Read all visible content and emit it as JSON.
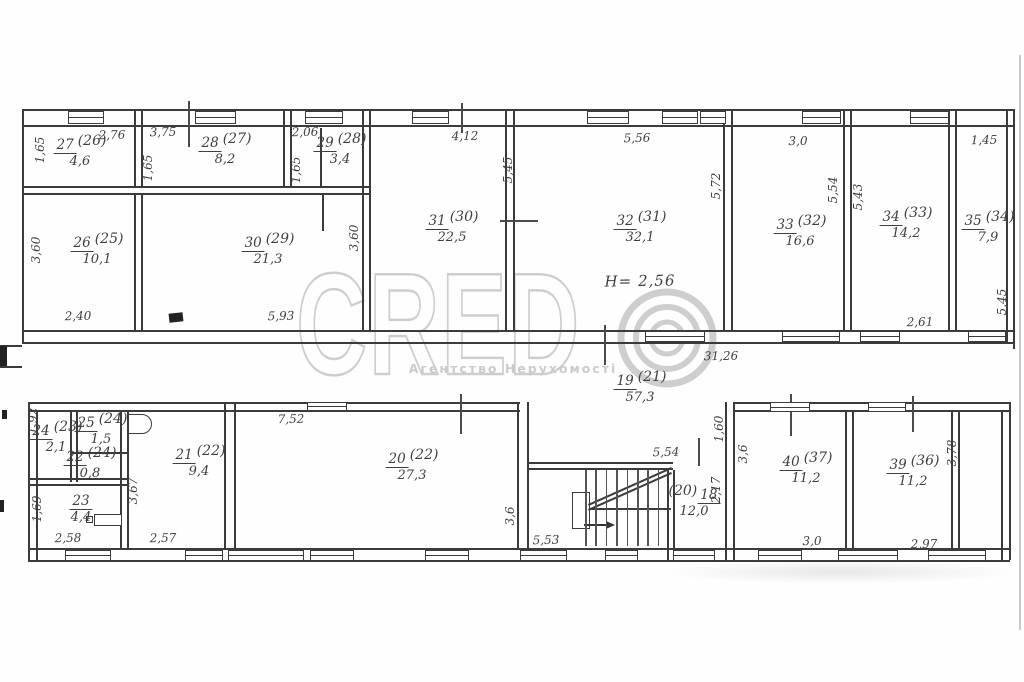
{
  "watermark": {
    "brand": "CREDO",
    "brand_text": "CRED",
    "subtitle": "Агентство Нерухомості"
  },
  "colors": {
    "ink": "#3b3b3b",
    "hand": "#3f3f3f",
    "watermark": "#c6c6c6"
  },
  "height_note": "Н= 2,56",
  "rooms": [
    {
      "n": "27",
      "o": "(26)",
      "a": "4,6",
      "x": 80,
      "y": 138
    },
    {
      "n": "28",
      "o": "(27)",
      "a": "8,2",
      "x": 225,
      "y": 136
    },
    {
      "n": "29",
      "o": "(28)",
      "a": "3,4",
      "x": 340,
      "y": 136
    },
    {
      "n": "26",
      "o": "(25)",
      "a": "10,1",
      "x": 97,
      "y": 236
    },
    {
      "n": "30",
      "o": "(29)",
      "a": "21,3",
      "x": 268,
      "y": 236
    },
    {
      "n": "31",
      "o": "(30)",
      "a": "22,5",
      "x": 452,
      "y": 214
    },
    {
      "n": "32",
      "o": "(31)",
      "a": "32,1",
      "x": 640,
      "y": 214
    },
    {
      "n": "33",
      "o": "(32)",
      "a": "16,6",
      "x": 800,
      "y": 218
    },
    {
      "n": "34",
      "o": "(33)",
      "a": "14,2",
      "x": 906,
      "y": 210
    },
    {
      "n": "35",
      "o": "(34)",
      "a": "7,9",
      "x": 988,
      "y": 214
    },
    {
      "n": "19",
      "o": "(21)",
      "a": "57,3",
      "x": 640,
      "y": 374
    },
    {
      "n": "24",
      "o": "(23)",
      "a": "2,1",
      "x": 56,
      "y": 424
    },
    {
      "n": "25",
      "o": "(24)",
      "a": "1,5",
      "x": 101,
      "y": 416
    },
    {
      "n": "22",
      "o": "(24)",
      "a": "0,8",
      "x": 90,
      "y": 450
    },
    {
      "n": "23",
      "o": "",
      "a": "4,4",
      "x": 81,
      "y": 494
    },
    {
      "n": "21",
      "o": "(22)",
      "a": "9,4",
      "x": 199,
      "y": 448
    },
    {
      "n": "20",
      "o": "(22)",
      "a": "27,3",
      "x": 412,
      "y": 452
    },
    {
      "n": "18",
      "o": "(20)",
      "a": "12,0",
      "x": 694,
      "y": 488,
      "oldFirst": true
    },
    {
      "n": "40",
      "o": "(37)",
      "a": "11,2",
      "x": 806,
      "y": 455
    },
    {
      "n": "39",
      "o": "(36)",
      "a": "11,2",
      "x": 913,
      "y": 458
    }
  ],
  "dims": [
    {
      "t": "2,76",
      "x": 112,
      "y": 135
    },
    {
      "t": "3,75",
      "x": 163,
      "y": 132
    },
    {
      "t": "2,06",
      "x": 305,
      "y": 132
    },
    {
      "t": "4,12",
      "x": 465,
      "y": 136
    },
    {
      "t": "5,56",
      "x": 637,
      "y": 138
    },
    {
      "t": "3,0",
      "x": 798,
      "y": 141
    },
    {
      "t": "1,45",
      "x": 984,
      "y": 140
    },
    {
      "t": "1,65",
      "x": 40,
      "y": 150,
      "v": true
    },
    {
      "t": "1,65",
      "x": 148,
      "y": 168,
      "v": true
    },
    {
      "t": "1,65",
      "x": 296,
      "y": 170,
      "v": true
    },
    {
      "t": "3,60",
      "x": 36,
      "y": 250,
      "v": true
    },
    {
      "t": "3,60",
      "x": 354,
      "y": 238,
      "v": true
    },
    {
      "t": "5,45",
      "x": 508,
      "y": 170,
      "v": true
    },
    {
      "t": "5,72",
      "x": 716,
      "y": 186,
      "v": true
    },
    {
      "t": "5,54",
      "x": 833,
      "y": 190,
      "v": true
    },
    {
      "t": "5,43",
      "x": 858,
      "y": 197,
      "v": true
    },
    {
      "t": "2,40",
      "x": 78,
      "y": 316
    },
    {
      "t": "5,93",
      "x": 281,
      "y": 316
    },
    {
      "t": "31,26",
      "x": 721,
      "y": 356
    },
    {
      "t": "2,61",
      "x": 920,
      "y": 322
    },
    {
      "t": "5,45",
      "x": 1002,
      "y": 302,
      "v": true
    },
    {
      "t": "Н= 2,56",
      "x": 640,
      "y": 281,
      "big": true
    },
    {
      "t": "1,92",
      "x": 33,
      "y": 421,
      "v": true
    },
    {
      "t": "7,52",
      "x": 291,
      "y": 419
    },
    {
      "t": "1,60",
      "x": 719,
      "y": 429,
      "v": true
    },
    {
      "t": "5,54",
      "x": 666,
      "y": 452
    },
    {
      "t": "2,17",
      "x": 716,
      "y": 490,
      "v": true
    },
    {
      "t": "3,67",
      "x": 133,
      "y": 491,
      "v": true
    },
    {
      "t": "1,69",
      "x": 37,
      "y": 509,
      "v": true
    },
    {
      "t": "3,6",
      "x": 510,
      "y": 516,
      "v": true
    },
    {
      "t": "3,6",
      "x": 743,
      "y": 454,
      "v": true
    },
    {
      "t": "2,58",
      "x": 68,
      "y": 538
    },
    {
      "t": "2,57",
      "x": 163,
      "y": 538
    },
    {
      "t": "5,53",
      "x": 546,
      "y": 540
    },
    {
      "t": "3,0",
      "x": 812,
      "y": 541
    },
    {
      "t": "2,97",
      "x": 924,
      "y": 544
    },
    {
      "t": "3,78",
      "x": 952,
      "y": 453,
      "v": true
    }
  ]
}
